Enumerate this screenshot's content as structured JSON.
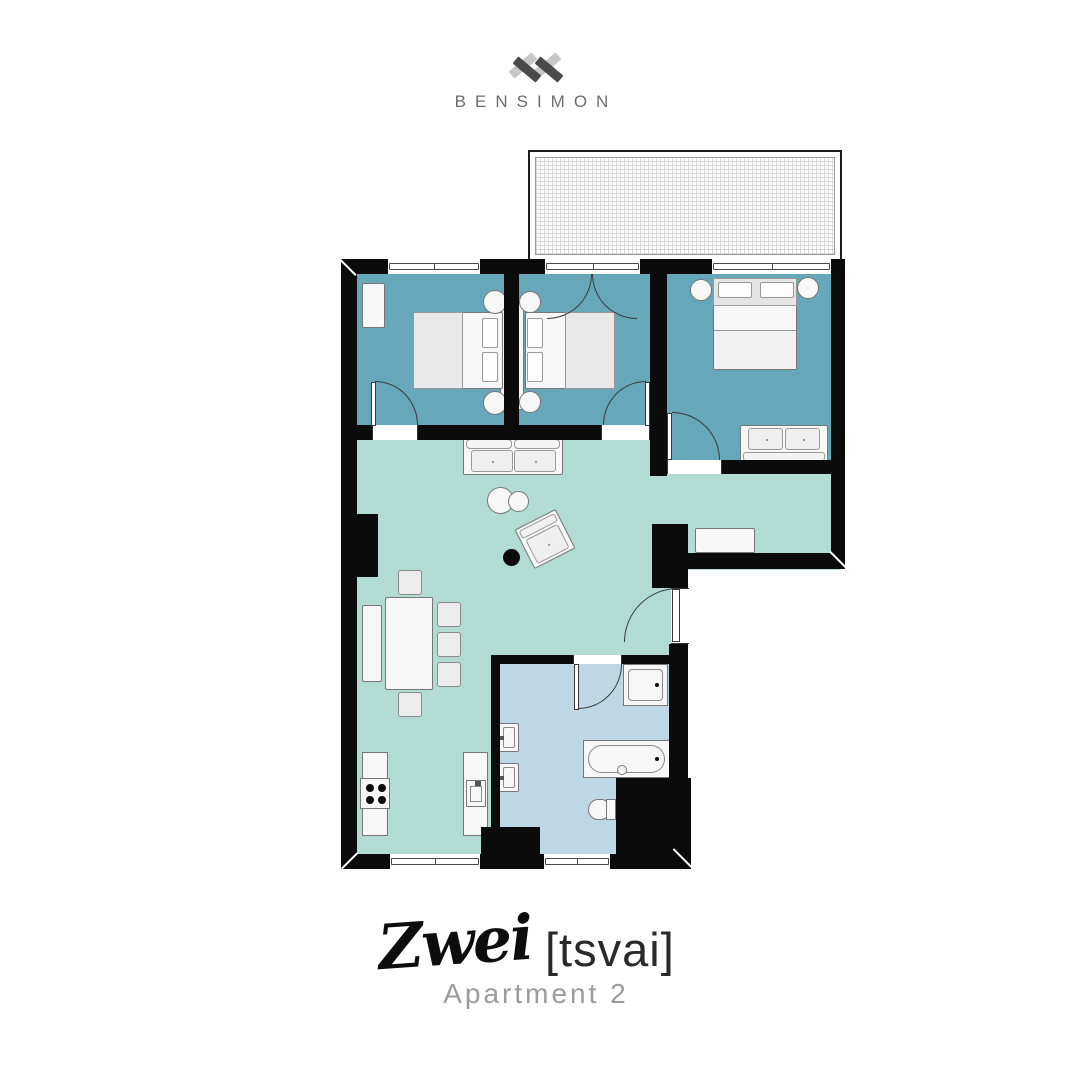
{
  "brand": {
    "name": "BENSIMON",
    "mark": "double-x-monogram"
  },
  "title": {
    "name": "Zwei",
    "phonetic": "[tsvai]",
    "subtitle": "Apartment 2"
  },
  "colors": {
    "bedroom": "#66a8b9",
    "living": "#b2dbd4",
    "bathroom": "#bed7e4",
    "wall": "#0b0b0b",
    "balcony_grid": "#d8d8d8",
    "fur_fill": "#f7f7f7",
    "fur_line": "#777777",
    "logo_light": "#c7c7c7",
    "logo_dark": "#4a4a4a",
    "text_gray": "#9b9b9b",
    "brand_gray": "#6e6e6e"
  },
  "floorplan": {
    "rooms": [
      {
        "id": "bedroom-1",
        "type": "bedroom",
        "furniture": [
          "wardrobe",
          "double-bed",
          "nightstand x2"
        ]
      },
      {
        "id": "bedroom-2",
        "type": "bedroom",
        "furniture": [
          "double-bed",
          "nightstand x2",
          "balcony-french-door"
        ]
      },
      {
        "id": "bedroom-3",
        "type": "bedroom",
        "furniture": [
          "double-bed",
          "nightstand x2",
          "sofa"
        ]
      },
      {
        "id": "living-dining-kitchen",
        "type": "living",
        "furniture": [
          "sofa",
          "coffee-table x2",
          "armchair",
          "side-table",
          "dining-table",
          "chair x5",
          "sideboard x2",
          "kitchen-counter",
          "stove",
          "kitchen-island",
          "sink"
        ]
      },
      {
        "id": "bathroom",
        "type": "bathroom",
        "furniture": [
          "shower",
          "washbasin x2",
          "bathtub",
          "toilet"
        ]
      },
      {
        "id": "balcony",
        "type": "balcony",
        "furniture": []
      }
    ]
  }
}
